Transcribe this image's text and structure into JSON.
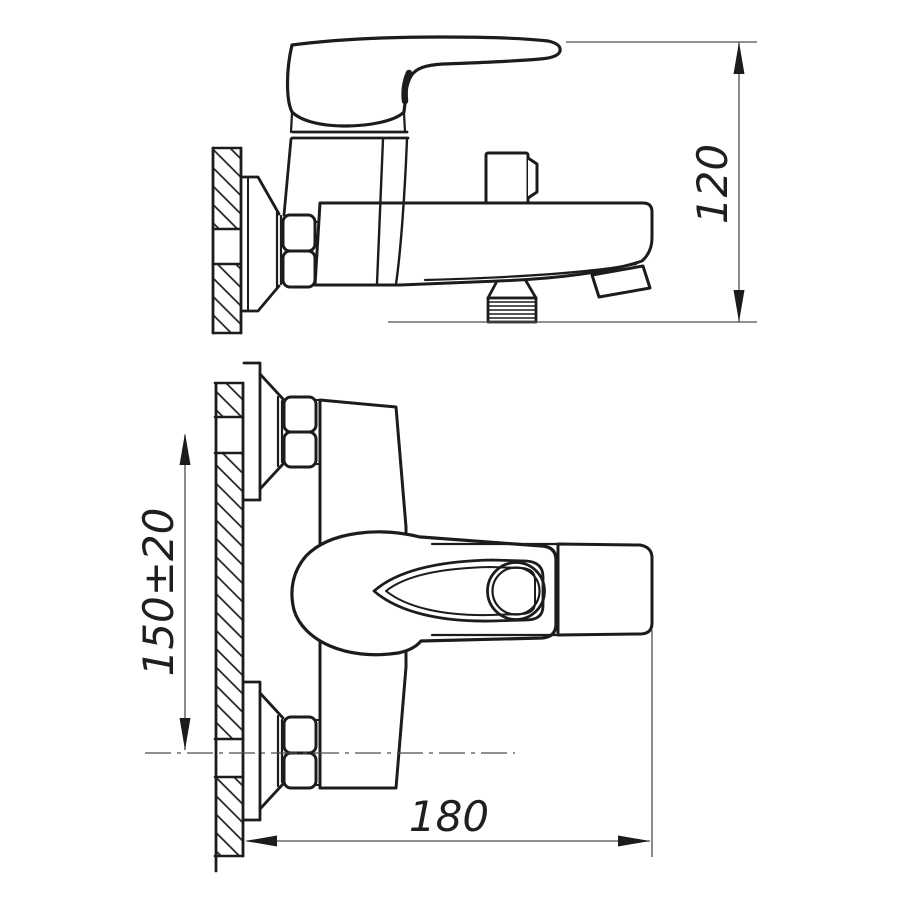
{
  "dimensions": {
    "height": {
      "label": "120"
    },
    "pipe_spacing": {
      "label": "150±20"
    },
    "length": {
      "label": "180"
    }
  },
  "colors": {
    "ink": "#1c1c1c",
    "dim_line": "#4d4d4d",
    "background": "#ffffff"
  }
}
